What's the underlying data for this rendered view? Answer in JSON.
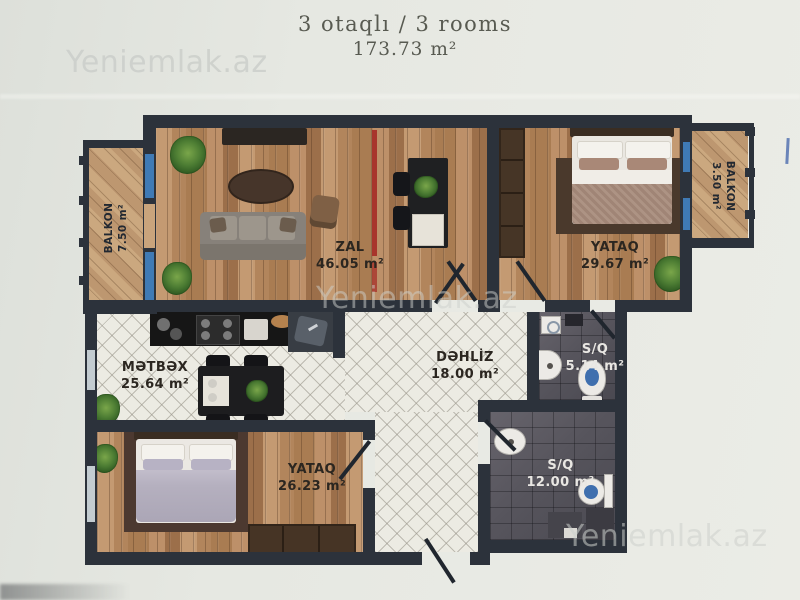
{
  "title": {
    "line1": "3 otaqlı / 3 rooms",
    "line2": "173.73 m²"
  },
  "watermark": "Yeniemlak.az",
  "rooms": {
    "balkon_left": {
      "name": "BALKON",
      "area": "7.50 m²"
    },
    "zal": {
      "name": "ZAL",
      "area": "46.05 m²"
    },
    "yataq_top": {
      "name": "YATAQ",
      "area": "29.67 m²"
    },
    "balkon_right": {
      "name": "BALKON",
      "area": "3.50 m²"
    },
    "metbex": {
      "name": "MƏTBƏX",
      "area": "25.64 m²"
    },
    "dehliz": {
      "name": "DƏHLİZ",
      "area": "18.00 m²"
    },
    "sq_small": {
      "name": "S/Q",
      "area": "5.14 m²"
    },
    "sq_large": {
      "name": "S/Q",
      "area": "12.00 m²"
    },
    "yataq_bottom": {
      "name": "YATAQ",
      "area": "26.23 m²"
    }
  },
  "colors": {
    "wall": "#2c323b",
    "window_glass": "#3f7ab5",
    "paper": "#e7e9e3",
    "wood_floor": "#b98c63",
    "balcony_floor": "#c8a47c",
    "tile_light": "#ecebe3",
    "tile_dark": "#57555d",
    "radiator_mark": "#b23a30"
  }
}
